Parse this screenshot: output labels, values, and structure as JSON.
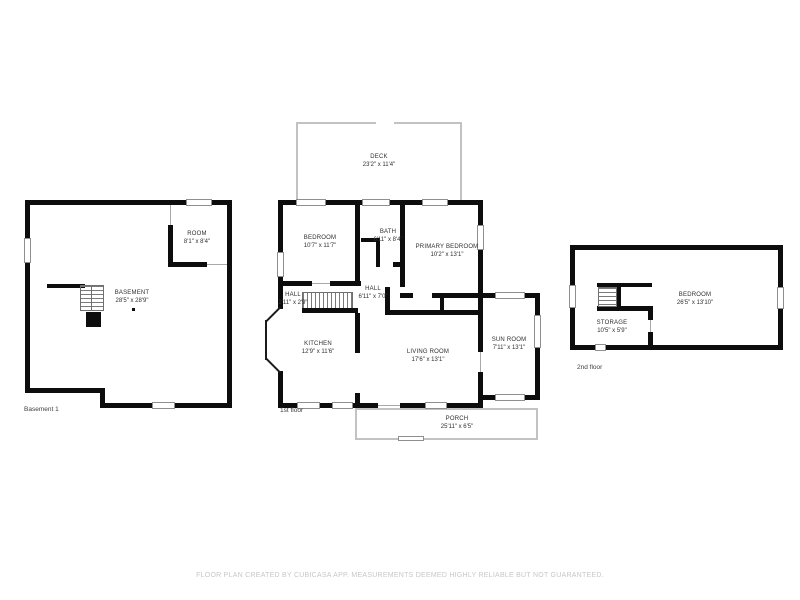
{
  "footer": {
    "disclaimer": "FLOOR PLAN CREATED BY CUBICASA APP. MEASUREMENTS DEEMED HIGHLY RELIABLE BUT NOT GUARANTEED."
  },
  "colors": {
    "wall": "#0d0d0d",
    "thin_wall": "#c2c2c2",
    "label_text": "#2f2f2f",
    "disclaimer_text": "#c7c7c7",
    "background": "#ffffff"
  },
  "basement": {
    "floor_label": "Basement 1",
    "rooms": {
      "room": {
        "name": "ROOM",
        "dims": "8'1\" x 8'4\""
      },
      "basement": {
        "name": "BASEMENT",
        "dims": "28'5\" x 28'9\""
      }
    }
  },
  "first_floor": {
    "floor_label": "1st floor",
    "rooms": {
      "deck": {
        "name": "DECK",
        "dims": "23'2\" x 11'4\""
      },
      "bedroom": {
        "name": "BEDROOM",
        "dims": "10'7\" x 11'7\""
      },
      "bath": {
        "name": "BATH",
        "dims": "6'11\" x 8'4\""
      },
      "primary_bedroom": {
        "name": "PRIMARY BEDROOM",
        "dims": "10'2\" x 13'1\""
      },
      "hall_small": {
        "name": "HALL",
        "dims": "2'11\" x 2'9\""
      },
      "hall": {
        "name": "HALL",
        "dims": "6'11\" x 7'0\""
      },
      "kitchen": {
        "name": "KITCHEN",
        "dims": "12'9\" x 11'6\""
      },
      "living_room": {
        "name": "LIVING ROOM",
        "dims": "17'6\" x 13'1\""
      },
      "sun_room": {
        "name": "SUN ROOM",
        "dims": "7'11\" x 13'1\""
      },
      "porch": {
        "name": "PORCH",
        "dims": "25'11\" x 6'5\""
      }
    }
  },
  "second_floor": {
    "floor_label": "2nd floor",
    "rooms": {
      "bedroom": {
        "name": "BEDROOM",
        "dims": "26'5\" x 13'10\""
      },
      "storage": {
        "name": "STORAGE",
        "dims": "10'5\" x 5'9\""
      }
    }
  }
}
